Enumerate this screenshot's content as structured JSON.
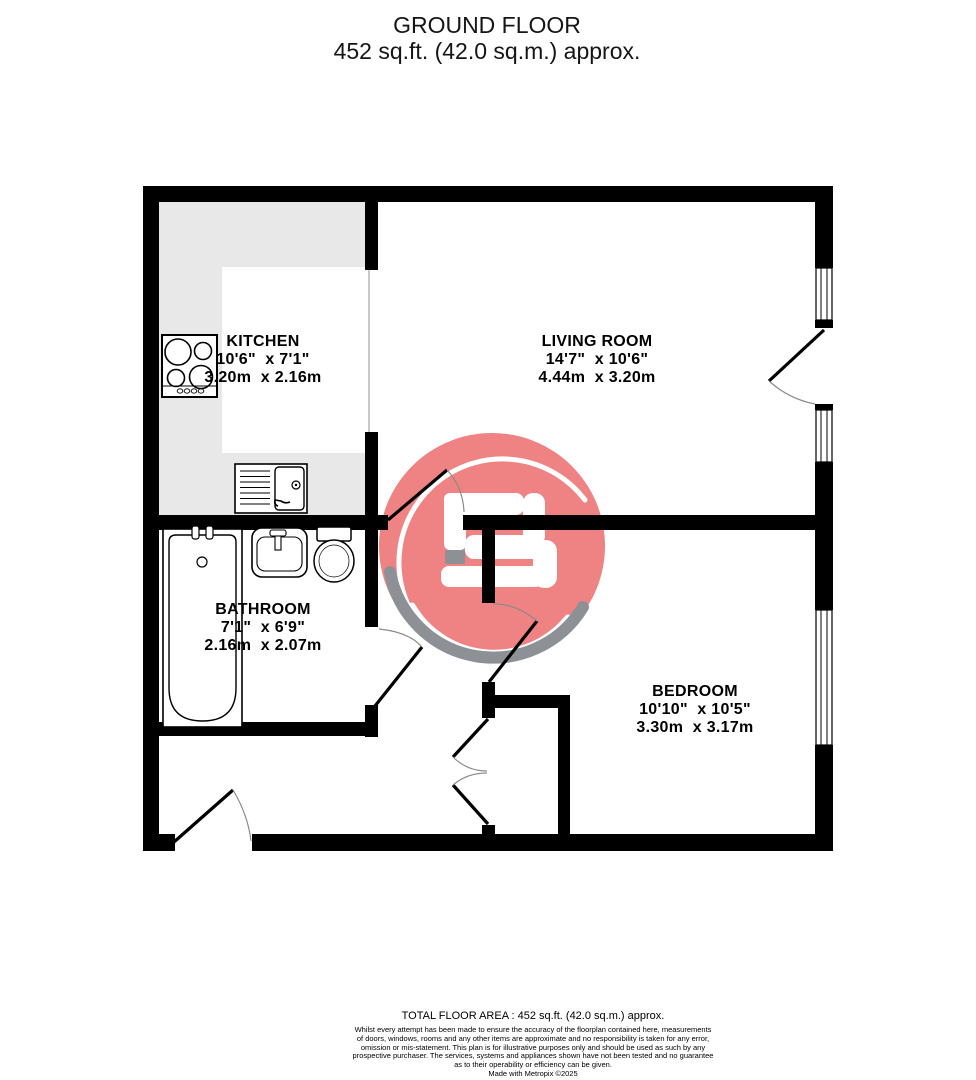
{
  "title": {
    "line1": "GROUND FLOOR",
    "line2": "452 sq.ft. (42.0 sq.m.) approx."
  },
  "rooms": {
    "kitchen": {
      "name": "KITCHEN",
      "imperial": "10'6\"  x 7'1\"",
      "metric": "3.20m  x 2.16m"
    },
    "living": {
      "name": "LIVING ROOM",
      "imperial": "14'7\"  x 10'6\"",
      "metric": "4.44m  x 3.20m"
    },
    "bathroom": {
      "name": "BATHROOM",
      "imperial": "7'1\"  x 6'9\"",
      "metric": "2.16m  x 2.07m"
    },
    "bedroom": {
      "name": "BEDROOM",
      "imperial": "10'10\"  x 10'5\"",
      "metric": "3.30m  x 3.17m"
    }
  },
  "footer": {
    "total": "TOTAL FLOOR AREA : 452 sq.ft. (42.0 sq.m.) approx.",
    "disclaimer_lines": [
      "Whilst every attempt has been made to ensure the accuracy of the floorplan contained here, measurements",
      "of doors, windows, rooms and any other items are approximate and no responsibility is taken for any error,",
      "omission or mis-statement. This plan is for illustrative purposes only and should be used as such by any",
      "prospective purchaser. The services, systems and appliances shown have not been tested and no guarantee",
      "as to their operability or efficiency can be given."
    ],
    "credit": "Made with Metropix ©2025"
  },
  "colors": {
    "wall": "#000000",
    "kitchen_counter": "#e8e8e8",
    "logo_red": "#ef8383",
    "logo_gray": "#8d9196",
    "door_arc": "#8a8a8a"
  }
}
